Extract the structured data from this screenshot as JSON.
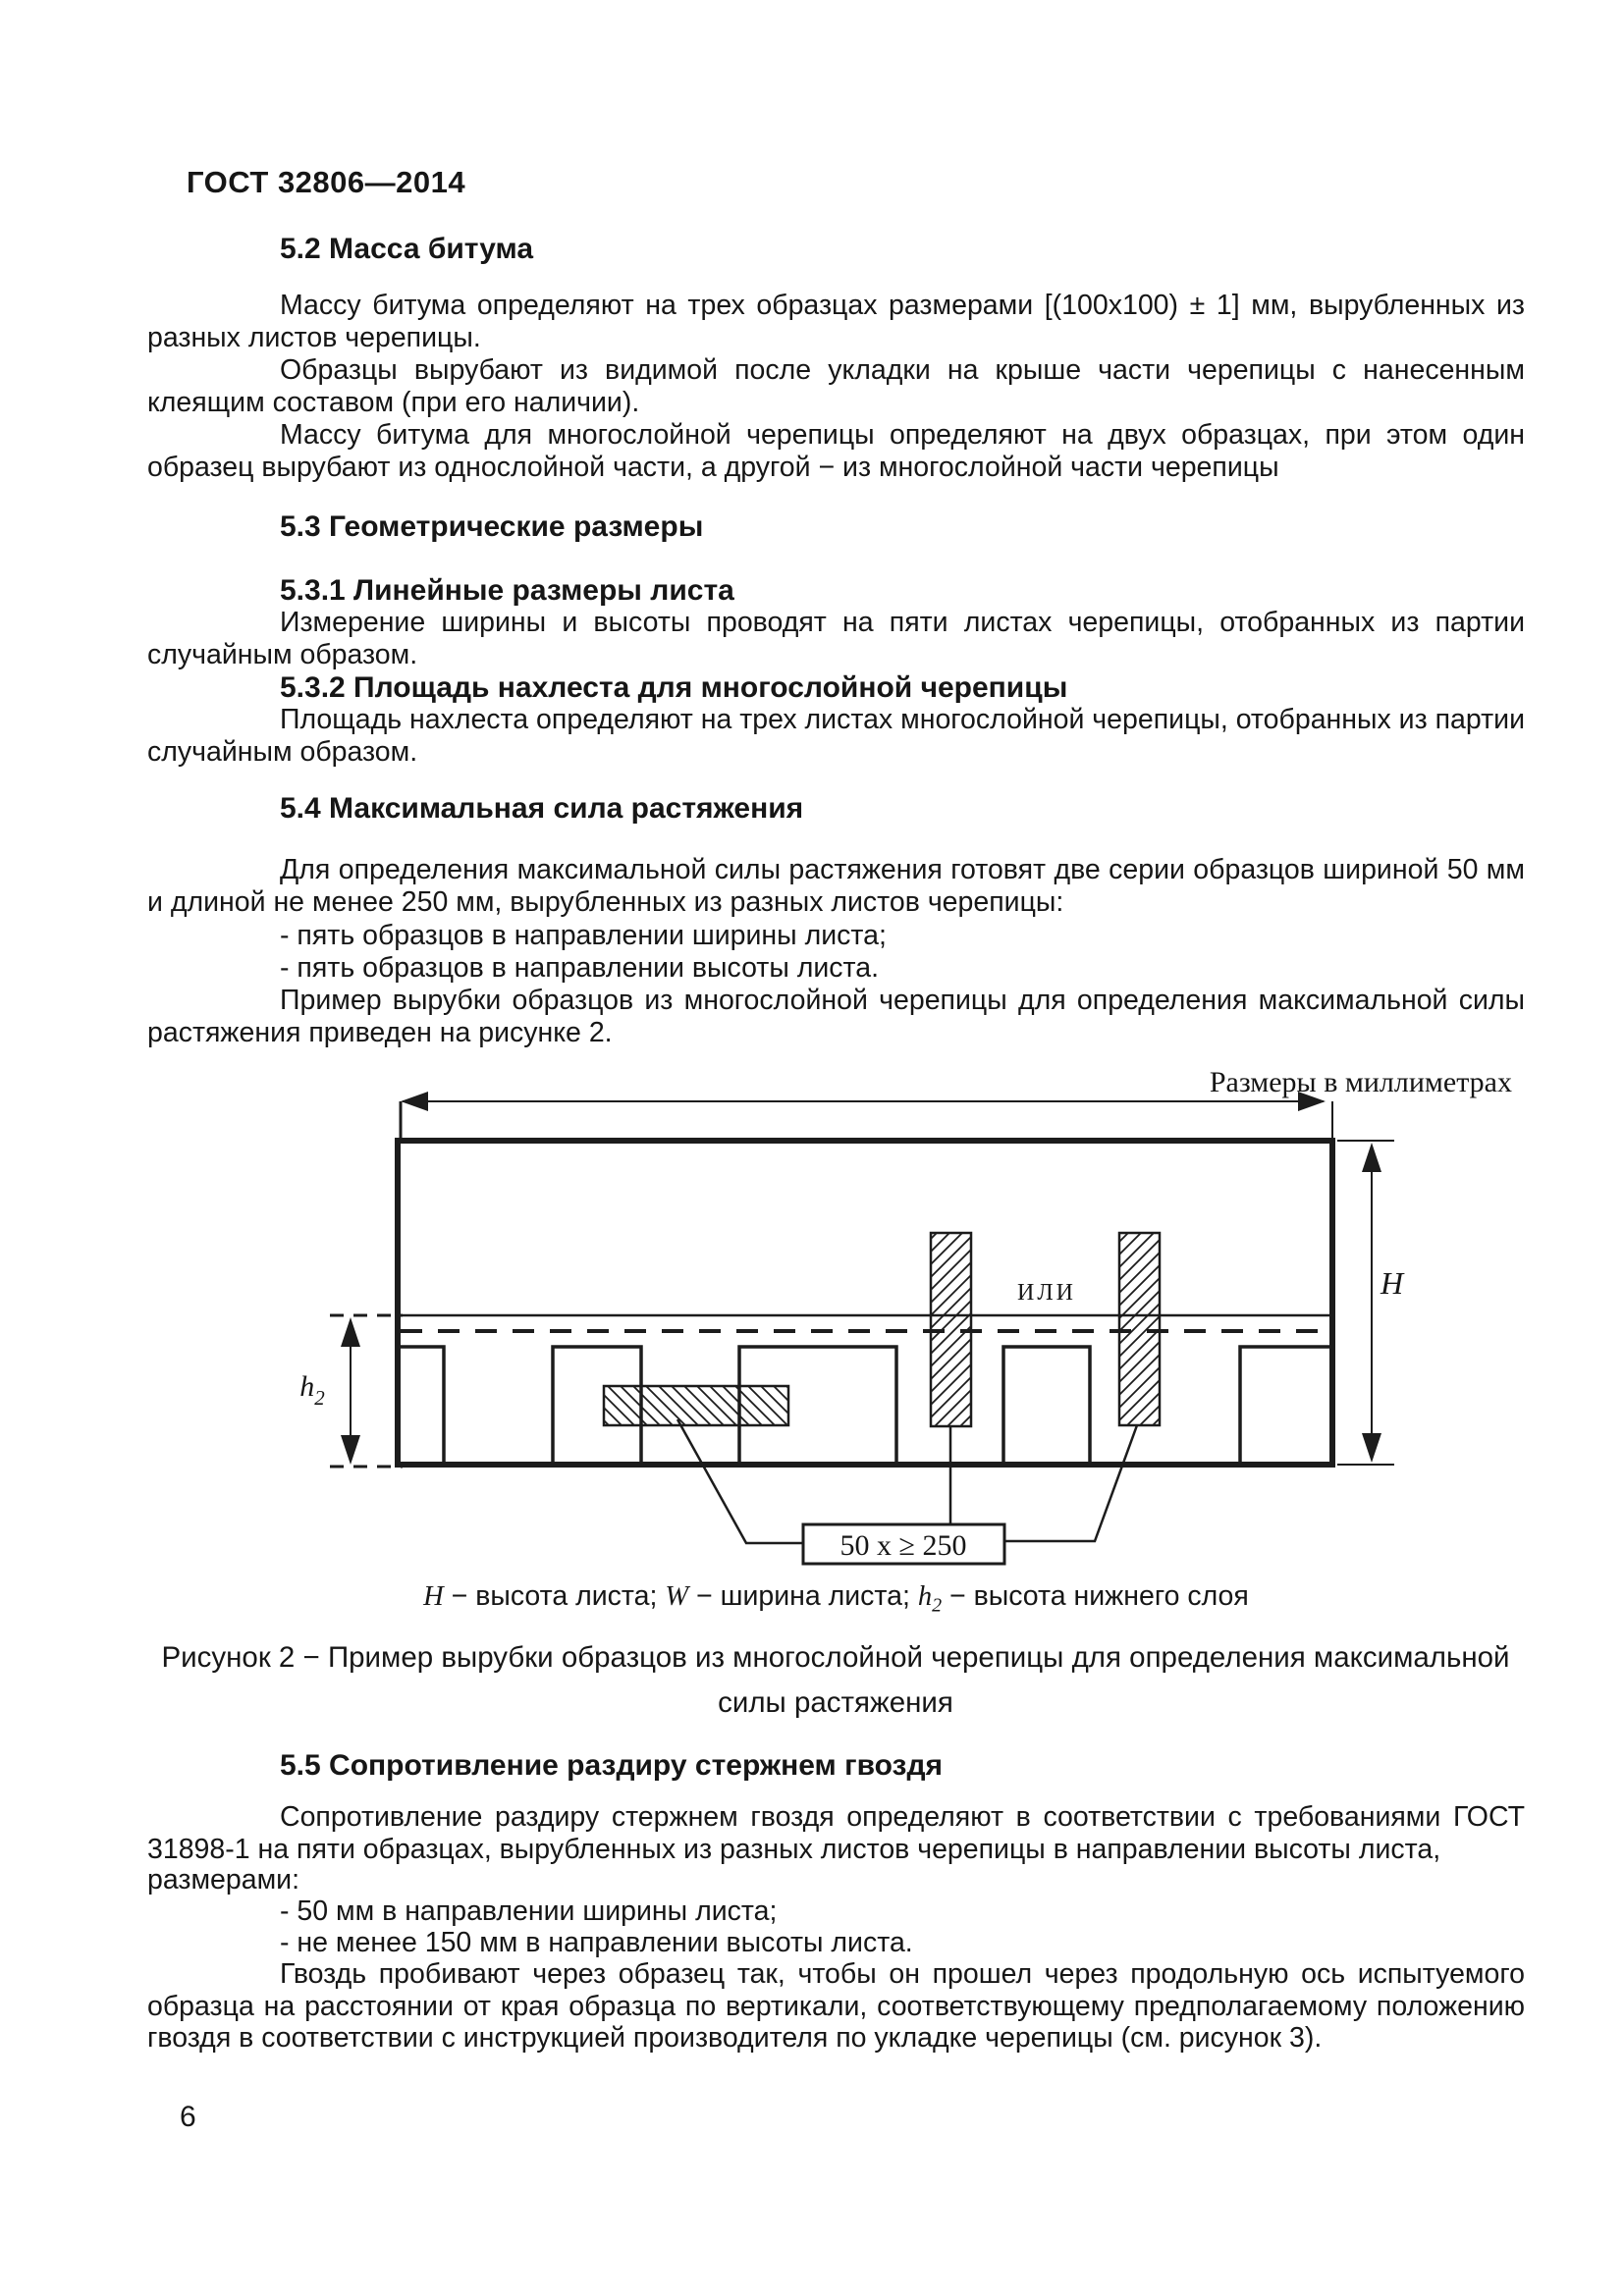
{
  "page": {
    "header": "ГОСТ 32806—2014",
    "number": "6"
  },
  "s52": {
    "title": "5.2 Масса битума",
    "p1": "Массу битума определяют на трех образцах размерами [(100х100) ± 1] мм, вырубленных из разных листов черепицы.",
    "p2": "Образцы вырубают из видимой после укладки на крыше части черепицы с нанесенным клеящим составом (при его наличии).",
    "p3": "Массу битума для многослойной черепицы определяют на двух образцах, при этом один образец вырубают из однослойной части, а другой − из многослойной части черепицы"
  },
  "s53": {
    "title": "5.3 Геометрические размеры"
  },
  "s531": {
    "title": "5.3.1 Линейные размеры листа",
    "p1": "Измерение ширины и высоты проводят на пяти листах черепицы, отобранных из партии случайным образом."
  },
  "s532": {
    "title": "5.3.2 Площадь нахлеста для многослойной черепицы",
    "p1": "Площадь нахлеста определяют на трех листах многослойной черепицы, отобранных из партии случайным образом."
  },
  "s54": {
    "title": "5.4 Максимальная сила растяжения",
    "p1": "Для определения максимальной силы растяжения готовят две серии образцов шириной 50 мм и длиной не менее 250 мм, вырубленных из разных листов черепицы:",
    "b1": "- пять образцов в направлении ширины листа;",
    "b2": "- пять образцов в направлении высоты листа.",
    "p2": "Пример вырубки образцов из многослойной черепицы для определения максимальной силы растяжения приведен на рисунке 2."
  },
  "figure": {
    "units_label": "Размеры в миллиметрах",
    "or_label": "ИЛИ",
    "h_label": "H",
    "h2_base": "h",
    "h2_sub": "2",
    "size_box_label": "50 x ≥ 250"
  },
  "legend": {
    "h_sym": "H",
    "h_txt": " − высота листа; ",
    "w_sym": "W",
    "w_txt": " − ширина листа; ",
    "h2_base": "h",
    "h2_sub": "2",
    "h2_txt": " − высота нижнего слоя"
  },
  "caption": {
    "line1": "Рисунок 2 − Пример вырубки образцов из многослойной черепицы для определения максимальной",
    "line2": "силы растяжения"
  },
  "s55": {
    "title": "5.5 Сопротивление раздиру стержнем гвоздя",
    "p1": "Сопротивление  раздиру стержнем гвоздя определяют в соответствии с требованиями  ГОСТ 31898-1 на пяти образцах, вырубленных из разных листов черепицы в направлении высоты листа,",
    "p1_tail": "размерами:",
    "b1": "- 50 мм в направлении ширины листа;",
    "b2": "- не менее 150 мм в направлении высоты листа.",
    "p2": "Гвоздь пробивают через образец так, чтобы он прошел через продольную ось испытуемого образца на расстоянии от края образца по вертикали, соответствующему предполагаемому положению гвоздя в соответствии с инструкцией производителя по укладке черепицы (см. рисунок 3)."
  }
}
